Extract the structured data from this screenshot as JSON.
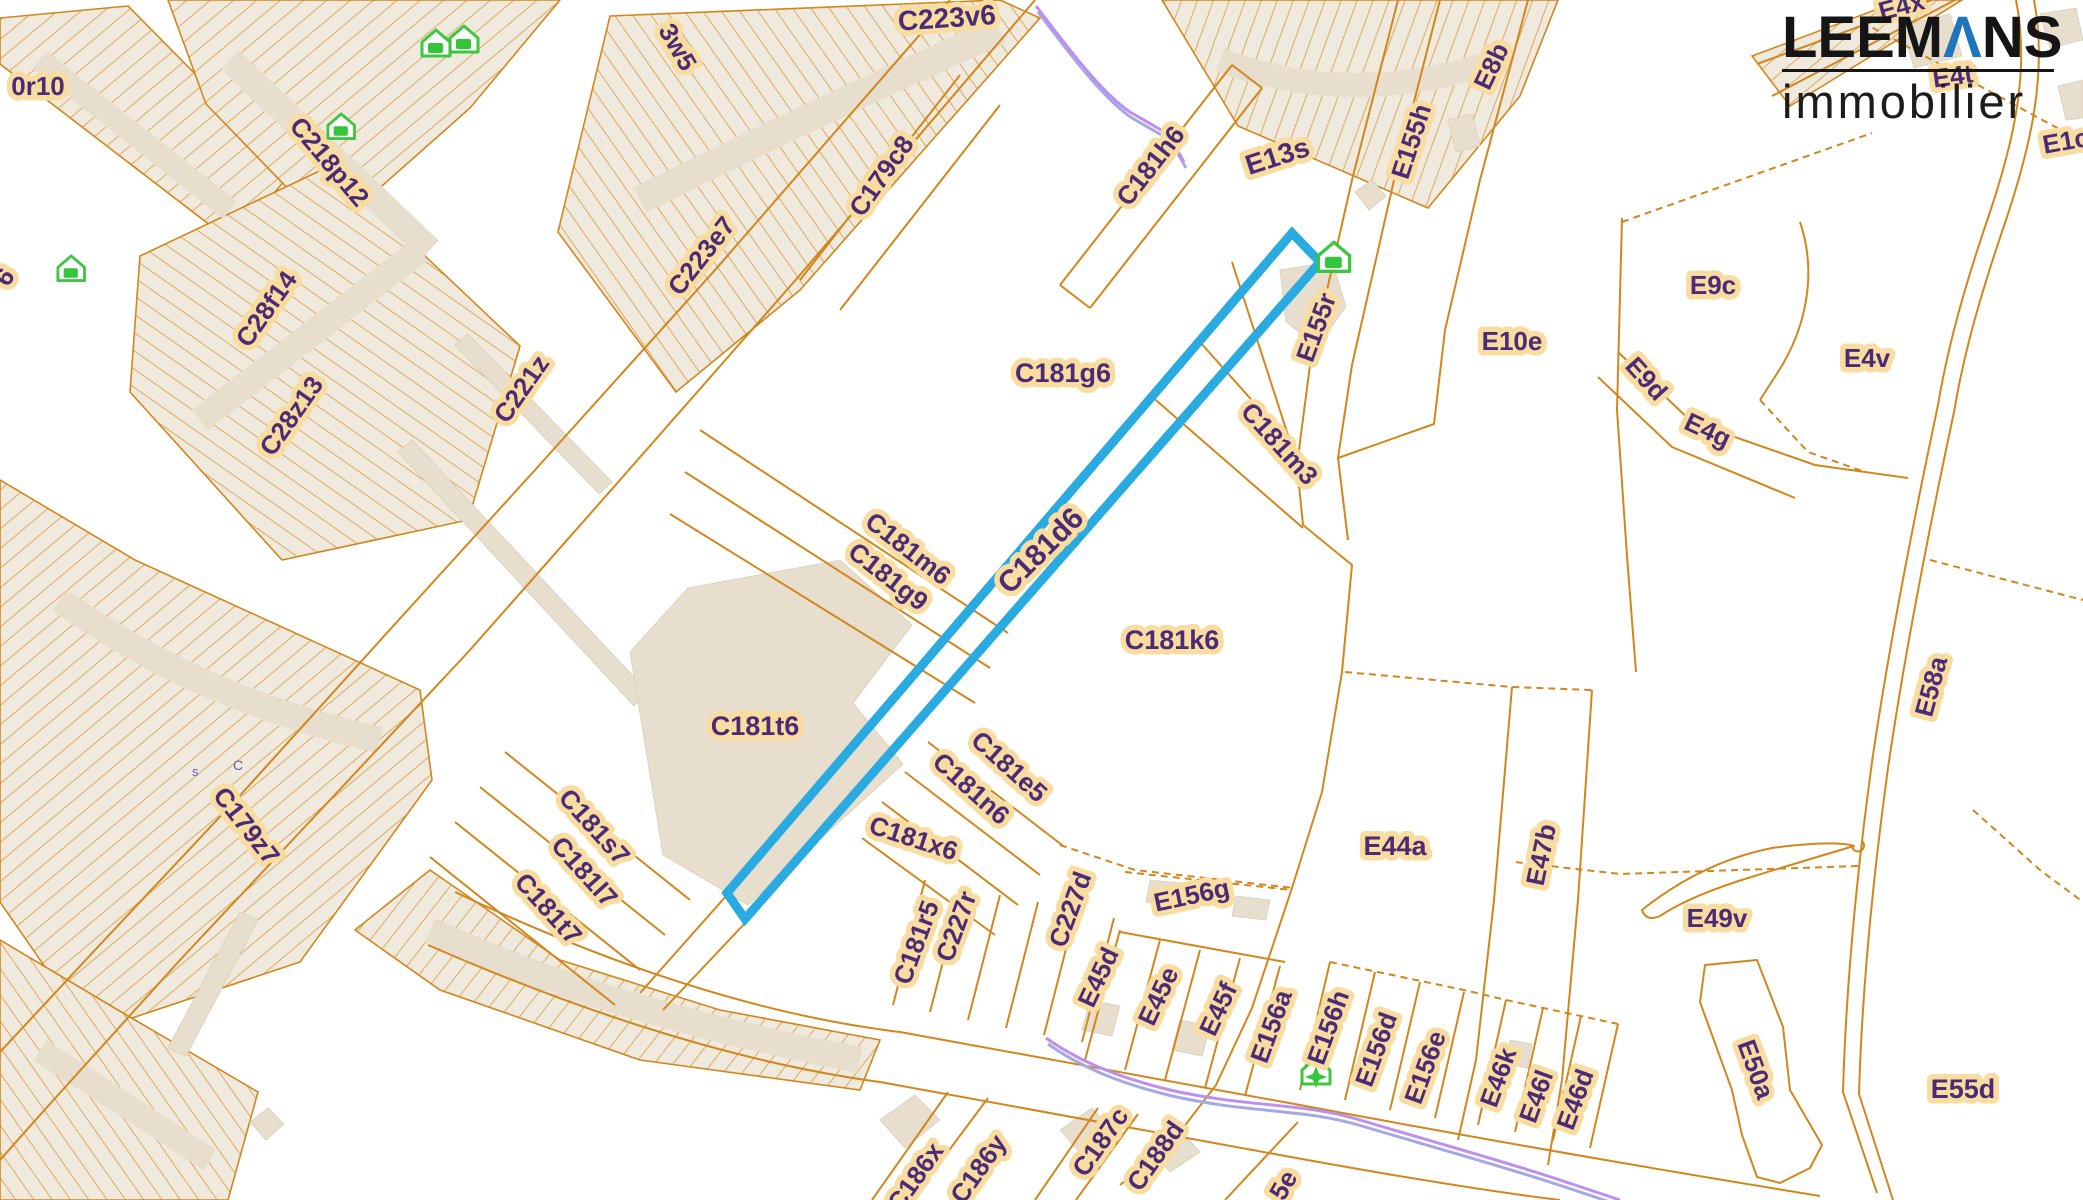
{
  "branding": {
    "wordmark_pre": "LEEM",
    "wordmark_a": "Λ",
    "wordmark_post": "NS",
    "subtitle": "immobilier",
    "wordmark_color": "#151515",
    "accent_color": "#1d76bc"
  },
  "map": {
    "background": "#ffffff",
    "parcel_line_color": "#d2861b",
    "block_fill": "#f0e9dd",
    "building_fill": "#e7decd",
    "label_color": "#4b2b76",
    "label_halo": "#f8dca0",
    "tiny_label_color": "#6b5bb0",
    "purple_line_color": "#bc90ec",
    "purple_line_color2": "#a5a8e8",
    "icon_color": "#35c53a",
    "highlight": {
      "label": "C181d6",
      "color": "#29abe2",
      "stroke_width": 9,
      "polygon": "1292,233 1320,262 745,919 727,893"
    },
    "blocks": [
      {
        "points": "0,18 128,6 292,172 232,242 0,64",
        "pattern": "p1"
      },
      {
        "points": "168,0 560,0 470,108 330,232 206,104",
        "pattern": "p1"
      },
      {
        "points": "140,256 330,166 520,346 468,520 282,560 130,392",
        "pattern": "p3"
      },
      {
        "points": "610,16 1000,0 1040,18 800,290 676,392 558,232",
        "pattern": "p2"
      },
      {
        "points": "0,480 135,560 420,690 432,780 300,962 90,1032 0,902",
        "pattern": "p1"
      },
      {
        "points": "0,940 118,1010 258,1092 228,1200 0,1200",
        "pattern": "p2"
      },
      {
        "points": "430,870 560,960 720,1010 880,1040 860,1090 640,1060 440,990 355,930",
        "pattern": "p4"
      },
      {
        "points": "1162,0 1558,0 1520,96 1428,208 1238,126",
        "pattern": "p5"
      },
      {
        "points": "1752,56 1902,0 1962,0 1790,106",
        "pattern": "p1"
      }
    ],
    "bands": [
      {
        "d": "M230,60 L430,250",
        "w": 26
      },
      {
        "d": "M40,60 L230,210",
        "w": 22
      },
      {
        "d": "M200,420 L420,250",
        "w": 26
      },
      {
        "d": "M640,200 Q800,120 1000,30",
        "w": 28
      },
      {
        "d": "M60,600 Q200,700 380,740",
        "w": 26
      },
      {
        "d": "M40,1050 L210,1160",
        "w": 24
      },
      {
        "d": "M430,930 Q600,1010 860,1060",
        "w": 26
      },
      {
        "d": "M1220,60 Q1350,110 1500,60",
        "w": 24
      }
    ],
    "buildings": [
      {
        "points": "398,452 412,440 648,692 634,706"
      },
      {
        "points": "455,345 468,334 612,482 599,494"
      },
      {
        "points": "630,652 688,588 840,560 912,625 853,703 903,764 748,905 663,855"
      },
      {
        "points": "168,1048 240,912 258,920 186,1056"
      },
      {
        "points": "250,1122 268,1108 284,1124 266,1140"
      },
      {
        "points": "1355,192 1372,180 1386,196 1369,210"
      },
      {
        "points": "1280,270 1332,262 1346,306 1318,346 1286,322"
      },
      {
        "points": "1902,26 1950,14 1962,56 1914,68"
      },
      {
        "points": "2040,14 2076,8 2083,40 2050,48"
      },
      {
        "points": "2058,86 2083,80 2083,118 2066,120"
      },
      {
        "points": "1150,880 1190,884 1186,906 1146,902"
      },
      {
        "points": "1236,896 1270,900 1266,920 1232,916"
      },
      {
        "points": "1090,1000 1120,1006 1112,1036 1082,1030"
      },
      {
        "points": "1180,1020 1210,1026 1202,1056 1172,1050"
      },
      {
        "points": "880,1120 915,1095 940,1120 905,1148"
      },
      {
        "points": "1060,1130 1092,1108 1114,1132 1082,1155"
      },
      {
        "points": "1150,1150 1180,1130 1200,1152 1170,1172"
      },
      {
        "points": "1510,1040 1532,1044 1528,1068 1506,1064"
      },
      {
        "points": "1560,1090 1582,1094 1578,1118 1556,1114"
      },
      {
        "points": "1448,120 1472,114 1480,146 1456,152"
      }
    ],
    "lines": [
      {
        "d": "M1398,0 L1352,180 L1310,365 L1297,465 L1303,525 L1352,565 L1342,672 L1322,792 L1292,888 L1252,1008 L1216,1085 L1170,1145 L1120,1185"
      },
      {
        "d": "M1440,0 L1394,180 L1352,365 L1338,458 L1348,540"
      },
      {
        "d": "M1528,0 L1480,180 L1445,330 L1434,424 L1338,458"
      },
      {
        "d": "M1622,218 L1617,410 L1627,556 L1636,672"
      },
      {
        "d": "M1345,672 L1512,687 L1592,690",
        "dash": true
      },
      {
        "d": "M1512,687 L1494,900 L1476,1060 L1458,1140"
      },
      {
        "d": "M1592,690 L1578,900 L1562,1080 L1548,1165"
      },
      {
        "d": "M1622,222 L1872,133",
        "dash": true
      },
      {
        "d": "M1800,222 C1818,275 1805,330 1778,372 L1760,400"
      },
      {
        "d": "M1760,400 L1808,452 L1865,472",
        "dash": true
      },
      {
        "d": "M1598,377 L1672,447 L1795,498"
      },
      {
        "d": "M1618,352 L1692,422 L1815,465 L1908,478"
      },
      {
        "d": "M1757,64 L1932,0"
      },
      {
        "d": "M1772,96 L1955,0"
      },
      {
        "d": "M1862,22 L2083,142",
        "dash": true
      },
      {
        "d": "M2016,0 C2030,70 2014,140 1990,212 C1965,285 1948,345 1938,405 C1912,528 1888,652 1872,762 C1857,872 1846,986 1843,1092 L1877,1193"
      },
      {
        "d": "M2034,0 C2048,74 2030,148 2006,220 C1981,293 1964,352 1954,412 C1928,534 1904,658 1888,768 C1873,878 1862,990 1859,1094 L1893,1200"
      },
      {
        "d": "M1858,866 L1620,874 L1515,862",
        "dash": true
      },
      {
        "d": "M1930,560 L2083,600",
        "dash": true
      },
      {
        "d": "M1973,810 L2040,870 L2083,902",
        "dash": true
      },
      {
        "d": "M1642,910 Q1702,862 1772,848 Q1834,840 1854,846 Q1800,862 1748,878 Q1690,896 1660,916 Q1646,922 1642,910 Z"
      },
      {
        "d": "M1852,845 a6,6 0 1,0 10,-4"
      },
      {
        "d": "M1705,965 L1757,960 L1783,1027 L1790,1090 L1822,1145 L1810,1168 L1780,1183 L1757,1177 L1742,1135 L1732,1090 L1700,1002 Z"
      },
      {
        "d": "M1035,0 L800,275 L620,480 L470,650 L330,800 L180,960 L40,1115 L0,1160"
      },
      {
        "d": "M950,0 L715,270 L535,470 L385,635 L245,790 L95,950 L0,1052"
      },
      {
        "d": "M1060,285 L1232,65"
      },
      {
        "d": "M1090,308 L1262,88"
      },
      {
        "d": "M1060,285 L1090,308"
      },
      {
        "d": "M1232,65 L1262,88"
      },
      {
        "d": "M700,430 L1008,633"
      },
      {
        "d": "M685,472 L990,668"
      },
      {
        "d": "M670,514 L975,703"
      },
      {
        "d": "M727,895 L640,993"
      },
      {
        "d": "M748,920 L663,1010"
      },
      {
        "d": "M1150,395 L1303,528"
      },
      {
        "d": "M1200,342 L1298,452"
      },
      {
        "d": "M1232,262 L1296,460"
      },
      {
        "d": "M1060,845 L1135,870 L1293,888",
        "dash": true
      },
      {
        "d": "M928,742 L1062,845"
      },
      {
        "d": "M905,772 L1040,875"
      },
      {
        "d": "M882,802 L1018,905"
      },
      {
        "d": "M862,838 L995,935"
      },
      {
        "d": "M893,1005 L925,880"
      },
      {
        "d": "M930,1012 L962,888"
      },
      {
        "d": "M968,1020 L1000,895"
      },
      {
        "d": "M1006,1028 L1038,902"
      },
      {
        "d": "M1044,1035 L1076,910"
      },
      {
        "d": "M1082,1042 L1114,918"
      },
      {
        "d": "M1085,1060 L1120,930"
      },
      {
        "d": "M1125,1070 L1160,940"
      },
      {
        "d": "M1165,1080 L1200,950"
      },
      {
        "d": "M1205,1088 L1240,958"
      },
      {
        "d": "M1245,1096 L1280,966"
      },
      {
        "d": "M1125,872 L1292,890",
        "dash": true
      },
      {
        "d": "M1120,932 L1285,962"
      },
      {
        "d": "M1300,1090 L1330,962"
      },
      {
        "d": "M1345,1100 L1375,972"
      },
      {
        "d": "M1390,1110 L1420,982"
      },
      {
        "d": "M1435,1118 L1464,992"
      },
      {
        "d": "M1478,1125 L1506,1000"
      },
      {
        "d": "M1515,1132 L1543,1008"
      },
      {
        "d": "M1553,1140 L1581,1016"
      },
      {
        "d": "M1590,1148 L1618,1024"
      },
      {
        "d": "M1330,962 L1464,990 L1506,1000 L1618,1024",
        "dash": true
      },
      {
        "d": "M455,892 Q700,1008 900,1032 Q1100,1068 1300,1105 Q1550,1152 1820,1196"
      },
      {
        "d": "M428,945 Q680,1055 880,1082 Q1080,1118 1280,1155 Q1460,1188 1560,1200"
      },
      {
        "d": "M505,752 L690,900"
      },
      {
        "d": "M480,787 L665,935"
      },
      {
        "d": "M455,822 L640,970"
      },
      {
        "d": "M430,857 L615,1005"
      },
      {
        "d": "M872,1200 L948,1092"
      },
      {
        "d": "M912,1200 L988,1098"
      },
      {
        "d": "M1035,1200 L1098,1108"
      },
      {
        "d": "M1076,1200 L1138,1114"
      },
      {
        "d": "M1225,1200 L1298,1122"
      },
      {
        "d": "M800,280 L960,75"
      },
      {
        "d": "M840,310 L1000,105"
      }
    ],
    "purple_lines": [
      {
        "d": "M1036,6 C1062,40 1100,92 1130,112 L1168,134 L1184,162"
      },
      {
        "d": "M1046,1038 C1080,1062 1120,1078 1170,1090 C1250,1108 1300,1102 1360,1120 C1440,1144 1500,1160 1560,1180 L1620,1200"
      }
    ],
    "icons": [
      {
        "type": "house",
        "x": 420,
        "y": 28,
        "s": 1.0
      },
      {
        "type": "house",
        "x": 448,
        "y": 24,
        "s": 1.0
      },
      {
        "type": "house",
        "x": 326,
        "y": 112,
        "s": 0.95
      },
      {
        "type": "house",
        "x": 56,
        "y": 254,
        "s": 0.95
      },
      {
        "type": "house-filled",
        "x": 1316,
        "y": 240,
        "s": 1.12
      },
      {
        "type": "house-star",
        "x": 1300,
        "y": 1056,
        "s": 1.0
      }
    ],
    "labels": [
      {
        "text": "0r10",
        "x": 38,
        "y": 88,
        "r": 0,
        "s": 26
      },
      {
        "text": "6",
        "x": 6,
        "y": 278,
        "r": -55,
        "s": 26
      },
      {
        "text": "3w5",
        "x": 676,
        "y": 48,
        "r": 60,
        "s": 26
      },
      {
        "text": "C223v6",
        "x": 947,
        "y": 20,
        "r": -4,
        "s": 28
      },
      {
        "text": "C218p12",
        "x": 328,
        "y": 163,
        "r": 50,
        "s": 26
      },
      {
        "text": "C28f14",
        "x": 268,
        "y": 310,
        "r": -55,
        "s": 26
      },
      {
        "text": "C28z13",
        "x": 293,
        "y": 417,
        "r": -55,
        "s": 26
      },
      {
        "text": "C221z",
        "x": 523,
        "y": 390,
        "r": -55,
        "s": 26
      },
      {
        "text": "C223e7",
        "x": 703,
        "y": 257,
        "r": -52,
        "s": 26
      },
      {
        "text": "C179c8",
        "x": 883,
        "y": 177,
        "r": -55,
        "s": 26
      },
      {
        "text": "C181h6",
        "x": 1152,
        "y": 167,
        "r": -52,
        "s": 26
      },
      {
        "text": "E13s",
        "x": 1278,
        "y": 158,
        "r": -18,
        "s": 28
      },
      {
        "text": "E155h",
        "x": 1413,
        "y": 142,
        "r": -72,
        "s": 26
      },
      {
        "text": "E8b",
        "x": 1493,
        "y": 67,
        "r": -65,
        "s": 26
      },
      {
        "text": "E4x",
        "x": 1902,
        "y": 8,
        "r": -15,
        "s": 26
      },
      {
        "text": "E4t",
        "x": 1953,
        "y": 78,
        "r": -8,
        "s": 26
      },
      {
        "text": "E1c",
        "x": 2066,
        "y": 143,
        "r": -10,
        "s": 26
      },
      {
        "text": "E9c",
        "x": 1713,
        "y": 287,
        "r": 0,
        "s": 26
      },
      {
        "text": "E10e",
        "x": 1512,
        "y": 343,
        "r": 0,
        "s": 26
      },
      {
        "text": "E4v",
        "x": 1867,
        "y": 360,
        "r": 0,
        "s": 26
      },
      {
        "text": "E9d",
        "x": 1645,
        "y": 380,
        "r": 48,
        "s": 26
      },
      {
        "text": "E4g",
        "x": 1707,
        "y": 432,
        "r": 25,
        "s": 26
      },
      {
        "text": "E155r",
        "x": 1318,
        "y": 328,
        "r": -70,
        "s": 26
      },
      {
        "text": "C181g6",
        "x": 1063,
        "y": 375,
        "r": 0,
        "s": 27
      },
      {
        "text": "C181m3",
        "x": 1278,
        "y": 445,
        "r": 48,
        "s": 26
      },
      {
        "text": "C181m6",
        "x": 907,
        "y": 550,
        "r": 38,
        "s": 26
      },
      {
        "text": "C181g9",
        "x": 887,
        "y": 578,
        "r": 38,
        "s": 26
      },
      {
        "text": "C181d6",
        "x": 1042,
        "y": 552,
        "r": -45,
        "s": 30
      },
      {
        "text": "C181k6",
        "x": 1172,
        "y": 642,
        "r": 0,
        "s": 27
      },
      {
        "text": "C181t6",
        "x": 755,
        "y": 728,
        "r": 0,
        "s": 27
      },
      {
        "text": "C179z7",
        "x": 245,
        "y": 827,
        "r": 52,
        "s": 26
      },
      {
        "text": "C181s7",
        "x": 593,
        "y": 828,
        "r": 48,
        "s": 26
      },
      {
        "text": "C181l7",
        "x": 583,
        "y": 873,
        "r": 48,
        "s": 26
      },
      {
        "text": "C181t7",
        "x": 547,
        "y": 910,
        "r": 48,
        "s": 26
      },
      {
        "text": "C181e5",
        "x": 1008,
        "y": 768,
        "r": 42,
        "s": 26
      },
      {
        "text": "C181n6",
        "x": 970,
        "y": 790,
        "r": 42,
        "s": 26
      },
      {
        "text": "C181x6",
        "x": 913,
        "y": 840,
        "r": 18,
        "s": 26
      },
      {
        "text": "C181r5",
        "x": 918,
        "y": 943,
        "r": -70,
        "s": 26
      },
      {
        "text": "C227r",
        "x": 958,
        "y": 927,
        "r": -70,
        "s": 26
      },
      {
        "text": "C227d",
        "x": 1072,
        "y": 910,
        "r": -70,
        "s": 26
      },
      {
        "text": "E45d",
        "x": 1100,
        "y": 978,
        "r": -65,
        "s": 26
      },
      {
        "text": "E45e",
        "x": 1160,
        "y": 997,
        "r": -65,
        "s": 26
      },
      {
        "text": "E45f",
        "x": 1220,
        "y": 1010,
        "r": -65,
        "s": 26
      },
      {
        "text": "E156a",
        "x": 1273,
        "y": 1027,
        "r": -70,
        "s": 26
      },
      {
        "text": "E156g",
        "x": 1192,
        "y": 897,
        "r": -12,
        "s": 26
      },
      {
        "text": "E156h",
        "x": 1330,
        "y": 1028,
        "r": -70,
        "s": 26
      },
      {
        "text": "E156d",
        "x": 1378,
        "y": 1050,
        "r": -70,
        "s": 26
      },
      {
        "text": "E156e",
        "x": 1427,
        "y": 1068,
        "r": -70,
        "s": 26
      },
      {
        "text": "E46k",
        "x": 1500,
        "y": 1078,
        "r": -70,
        "s": 26
      },
      {
        "text": "E46l",
        "x": 1538,
        "y": 1097,
        "r": -70,
        "s": 26
      },
      {
        "text": "E46d",
        "x": 1577,
        "y": 1100,
        "r": -70,
        "s": 26
      },
      {
        "text": "E44a",
        "x": 1395,
        "y": 848,
        "r": 0,
        "s": 27
      },
      {
        "text": "E47b",
        "x": 1543,
        "y": 855,
        "r": -78,
        "s": 26
      },
      {
        "text": "E49v",
        "x": 1717,
        "y": 920,
        "r": 0,
        "s": 26
      },
      {
        "text": "E58a",
        "x": 1933,
        "y": 687,
        "r": -75,
        "s": 26
      },
      {
        "text": "E50a",
        "x": 1754,
        "y": 1070,
        "r": 70,
        "s": 26
      },
      {
        "text": "E55d",
        "x": 1963,
        "y": 1091,
        "r": 0,
        "s": 27
      },
      {
        "text": "C186x",
        "x": 917,
        "y": 1178,
        "r": -55,
        "s": 26
      },
      {
        "text": "C186y",
        "x": 980,
        "y": 1170,
        "r": -55,
        "s": 26
      },
      {
        "text": "C187c",
        "x": 1102,
        "y": 1143,
        "r": -55,
        "s": 26
      },
      {
        "text": "C188d",
        "x": 1157,
        "y": 1157,
        "r": -55,
        "s": 26
      },
      {
        "text": "5e",
        "x": 1285,
        "y": 1186,
        "r": -60,
        "s": 26
      }
    ],
    "tiny_labels": [
      {
        "text": "s",
        "x": 192,
        "y": 776,
        "r": 0,
        "s": 13
      },
      {
        "text": "C",
        "x": 233,
        "y": 770,
        "r": 0,
        "s": 14
      }
    ]
  }
}
